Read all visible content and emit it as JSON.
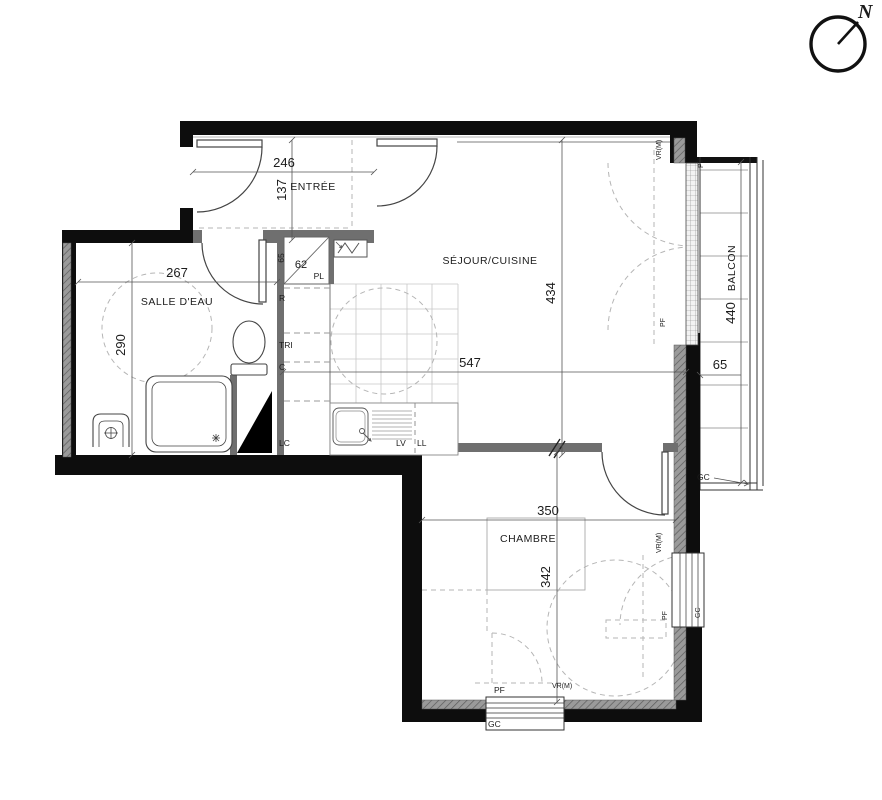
{
  "compass": {
    "north": "N"
  },
  "rooms": {
    "entree": {
      "name": "ENTRÉE",
      "w": "246",
      "h": "137"
    },
    "salle_deau": {
      "name": "SALLE D'EAU",
      "w": "267",
      "h": "290"
    },
    "sejour": {
      "name": "SÉJOUR/CUISINE",
      "w": "547",
      "h": "434"
    },
    "chambre": {
      "name": "CHAMBRE",
      "w": "350",
      "h": "342"
    },
    "balcon": {
      "name": "BALCON",
      "len": "440",
      "depth": "65"
    }
  },
  "closet": {
    "name": "PL",
    "w": "62",
    "h": "65"
  },
  "tags": {
    "r": "R",
    "tri": "TRI",
    "c": "C",
    "lc": "LC",
    "lv": "LV",
    "ll": "LL",
    "pf": "PF",
    "pv": "PV",
    "gc": "GC",
    "vrm": "VR(M)"
  }
}
